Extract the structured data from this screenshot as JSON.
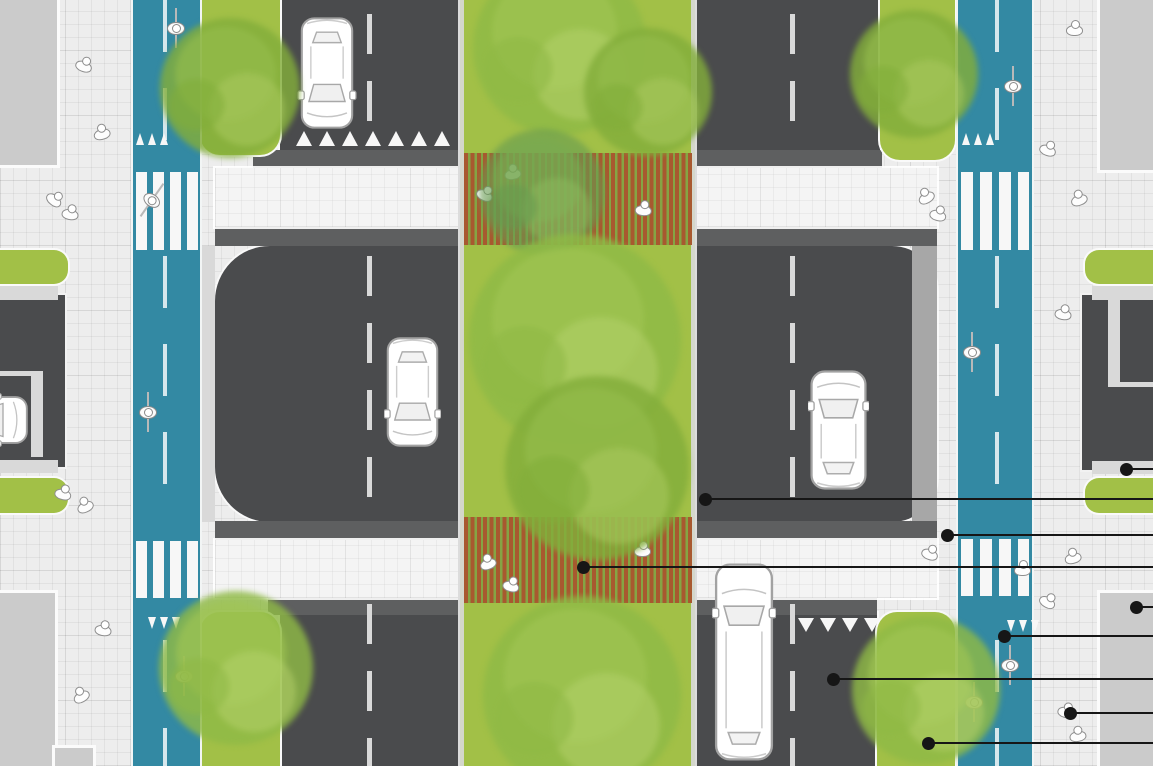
{
  "scene": {
    "width": 1153,
    "height": 766,
    "description": "top-down street plan with median walkway, raised crossings, protected bike lanes and callout markers"
  },
  "colors": {
    "sidewalk": "#ededed",
    "sidewalk_line": "rgba(0,0,0,0.05)",
    "crossing_table": "#f4f4f4",
    "crossing_table_line": "rgba(0,0,0,0.04)",
    "road": "#4a4b4d",
    "ramp": "#5e5f60",
    "bike_lane": "#3389a3",
    "grass": "#a2c047",
    "boardwalk_brown": "#a8592f",
    "boardwalk_gap": "#85a544",
    "building": "#cbcbcb",
    "curb_light": "#d9d9d9",
    "curb_gray": "#a7a7a7",
    "marking_white": "#f7f7f7",
    "road_dash": "#d9d9d9",
    "ink": "#161616"
  },
  "base": {
    "x": 0,
    "y": 0,
    "w": 1153,
    "h": 766
  },
  "buildings": [
    {
      "x": 0,
      "y": 0,
      "w": 57,
      "h": 165
    },
    {
      "x": 1100,
      "y": 0,
      "w": 53,
      "h": 170
    },
    {
      "x": 0,
      "y": 593,
      "w": 55,
      "h": 173
    },
    {
      "x": 1100,
      "y": 593,
      "w": 53,
      "h": 173
    },
    {
      "x": 55,
      "y": 748,
      "w": 38,
      "h": 18
    }
  ],
  "driveways": [
    {
      "part": "pavement",
      "x": 0,
      "y": 295,
      "w": 65,
      "h": 172
    },
    {
      "part": "curb",
      "x": 0,
      "y": 286,
      "w": 58,
      "h": 14
    },
    {
      "part": "curb",
      "x": 0,
      "y": 460,
      "w": 58,
      "h": 13
    },
    {
      "part": "divider",
      "x": 31,
      "y": 375,
      "w": 12,
      "h": 82
    },
    {
      "part": "divider",
      "x": 0,
      "y": 371,
      "w": 43,
      "h": 5
    },
    {
      "part": "pavement",
      "x": 1082,
      "y": 295,
      "w": 71,
      "h": 175
    },
    {
      "part": "curb",
      "x": 1092,
      "y": 286,
      "w": 61,
      "h": 14
    },
    {
      "part": "curb",
      "x": 1092,
      "y": 461,
      "w": 61,
      "h": 13
    },
    {
      "part": "divider",
      "x": 1108,
      "y": 300,
      "w": 12,
      "h": 84
    },
    {
      "part": "divider",
      "x": 1108,
      "y": 382,
      "w": 45,
      "h": 5
    }
  ],
  "roads": [
    {
      "x": 280,
      "y": 0,
      "w": 180,
      "h": 152
    },
    {
      "x": 695,
      "y": 0,
      "w": 185,
      "h": 152
    },
    {
      "x": 215,
      "y": 246,
      "w": 245,
      "h": 276,
      "r": "55px 0 0 55px"
    },
    {
      "x": 695,
      "y": 246,
      "w": 242,
      "h": 276,
      "r": "0 45px 45px 0"
    },
    {
      "x": 280,
      "y": 613,
      "w": 180,
      "h": 153
    },
    {
      "x": 695,
      "y": 613,
      "w": 182,
      "h": 153
    }
  ],
  "curbs": [
    {
      "x": 200,
      "y": 246,
      "w": 15,
      "h": 276,
      "fill": "curb_light"
    },
    {
      "x": 912,
      "y": 246,
      "w": 25,
      "h": 276,
      "fill": "curb_gray"
    }
  ],
  "ramps": [
    {
      "x": 253,
      "y": 150,
      "w": 207,
      "h": 18
    },
    {
      "x": 215,
      "y": 227,
      "w": 245,
      "h": 19
    },
    {
      "x": 695,
      "y": 150,
      "w": 187,
      "h": 18
    },
    {
      "x": 695,
      "y": 227,
      "w": 242,
      "h": 19
    },
    {
      "x": 215,
      "y": 521,
      "w": 245,
      "h": 19
    },
    {
      "x": 268,
      "y": 598,
      "w": 192,
      "h": 17
    },
    {
      "x": 695,
      "y": 521,
      "w": 242,
      "h": 19
    },
    {
      "x": 695,
      "y": 598,
      "w": 182,
      "h": 17
    }
  ],
  "crossing_tables": [
    {
      "x": 215,
      "y": 168,
      "w": 245,
      "h": 59
    },
    {
      "x": 695,
      "y": 168,
      "w": 242,
      "h": 59
    },
    {
      "x": 215,
      "y": 540,
      "w": 245,
      "h": 58
    },
    {
      "x": 695,
      "y": 540,
      "w": 242,
      "h": 58
    }
  ],
  "median": {
    "x": 460,
    "y": 0,
    "w": 235,
    "h": 766
  },
  "median_curbs": [
    {
      "x": 458,
      "y": 0,
      "w": 6,
      "h": 766
    },
    {
      "x": 691,
      "y": 0,
      "w": 6,
      "h": 766
    }
  ],
  "verges": [
    {
      "x": 200,
      "y": 0,
      "w": 80,
      "h": 155,
      "r": "0 0 20px 20px"
    },
    {
      "x": 880,
      "y": 0,
      "w": 75,
      "h": 160,
      "r": "0 0 20px 20px"
    },
    {
      "x": 0,
      "y": 250,
      "w": 68,
      "h": 34,
      "r": "0 14px 14px 0"
    },
    {
      "x": 0,
      "y": 478,
      "w": 68,
      "h": 35,
      "r": "0 14px 14px 0"
    },
    {
      "x": 1085,
      "y": 250,
      "w": 68,
      "h": 34,
      "r": "14px 0 0 14px"
    },
    {
      "x": 1085,
      "y": 478,
      "w": 68,
      "h": 35,
      "r": "14px 0 0 14px"
    },
    {
      "x": 200,
      "y": 612,
      "w": 80,
      "h": 154,
      "r": "20px 20px 0 0"
    },
    {
      "x": 877,
      "y": 612,
      "w": 78,
      "h": 154,
      "r": "20px 20px 0 0"
    }
  ],
  "boardwalks": [
    {
      "x": 464,
      "y": 153,
      "w": 228,
      "h": 92
    },
    {
      "x": 464,
      "y": 517,
      "w": 228,
      "h": 86
    }
  ],
  "bike_lanes": [
    {
      "x": 133,
      "y": 0,
      "w": 67,
      "h": 766
    },
    {
      "x": 958,
      "y": 0,
      "w": 74,
      "h": 766
    }
  ],
  "zebras": [
    {
      "x": 136,
      "y": 172,
      "w": 62,
      "h": 78,
      "bar": 11,
      "gap": 6
    },
    {
      "x": 961,
      "y": 172,
      "w": 68,
      "h": 78,
      "bar": 12,
      "gap": 7
    },
    {
      "x": 136,
      "y": 541,
      "w": 62,
      "h": 57,
      "bar": 11,
      "gap": 6
    },
    {
      "x": 961,
      "y": 539,
      "w": 68,
      "h": 57,
      "bar": 12,
      "gap": 7
    }
  ],
  "bike_dashes": [
    {
      "x": 163,
      "y": 0,
      "h": 146
    },
    {
      "x": 163,
      "y": 256,
      "h": 258
    },
    {
      "x": 163,
      "y": 640,
      "h": 126
    },
    {
      "x": 995,
      "y": 0,
      "h": 146
    },
    {
      "x": 995,
      "y": 256,
      "h": 258
    },
    {
      "x": 995,
      "y": 640,
      "h": 126
    }
  ],
  "road_dashes": [
    {
      "x": 367,
      "y": 14,
      "h": 132
    },
    {
      "x": 367,
      "y": 256,
      "h": 256
    },
    {
      "x": 367,
      "y": 604,
      "h": 162
    },
    {
      "x": 790,
      "y": 14,
      "h": 132
    },
    {
      "x": 790,
      "y": 256,
      "h": 256
    },
    {
      "x": 790,
      "y": 604,
      "h": 162
    }
  ],
  "teeth_rows": [
    {
      "x": 136,
      "y": 133,
      "count": 3,
      "tw": 9,
      "th": 12,
      "pitch": 12,
      "dir": "up"
    },
    {
      "x": 962,
      "y": 133,
      "count": 3,
      "tw": 9,
      "th": 12,
      "pitch": 12,
      "dir": "up"
    },
    {
      "x": 296,
      "y": 131,
      "count": 7,
      "tw": 16,
      "th": 15,
      "pitch": 23,
      "dir": "up"
    },
    {
      "x": 148,
      "y": 617,
      "count": 3,
      "tw": 9,
      "th": 12,
      "pitch": 12,
      "dir": "down"
    },
    {
      "x": 1007,
      "y": 620,
      "count": 3,
      "tw": 9,
      "th": 12,
      "pitch": 12,
      "dir": "down"
    },
    {
      "x": 798,
      "y": 618,
      "count": 4,
      "tw": 16,
      "th": 14,
      "pitch": 22,
      "dir": "down"
    }
  ],
  "tree_tones": {
    "base": [
      "#82ad3a",
      "#95bd4d",
      "#a9c95f"
    ],
    "mid": [
      "#8fb946",
      "#9fc553",
      "#b3cf69"
    ],
    "dark": [
      "#689b50",
      "#79aa52",
      "#8cb95d"
    ]
  },
  "trees": [
    {
      "cx": 560,
      "cy": 48,
      "r": 95,
      "tone": "mid"
    },
    {
      "cx": 648,
      "cy": 92,
      "r": 70,
      "tone": "base"
    },
    {
      "cx": 542,
      "cy": 192,
      "r": 68,
      "tone": "dark",
      "op": 0.6
    },
    {
      "cx": 575,
      "cy": 340,
      "r": 115,
      "tone": "mid"
    },
    {
      "cx": 597,
      "cy": 468,
      "r": 100,
      "tone": "base"
    },
    {
      "cx": 582,
      "cy": 695,
      "r": 108,
      "tone": "mid"
    },
    {
      "cx": 230,
      "cy": 88,
      "r": 76,
      "tone": "base"
    },
    {
      "cx": 236,
      "cy": 668,
      "r": 84,
      "tone": "mid"
    },
    {
      "cx": 914,
      "cy": 74,
      "r": 70,
      "tone": "base"
    },
    {
      "cx": 926,
      "cy": 690,
      "r": 80,
      "tone": "mid"
    }
  ],
  "vehicles": [
    {
      "type": "car",
      "x": 296,
      "y": 16,
      "w": 62,
      "h": 114,
      "facing": "down",
      "name": "parked-car"
    },
    {
      "type": "car",
      "x": 384,
      "y": 336,
      "w": 57,
      "h": 112,
      "facing": "down",
      "name": "car-southbound"
    },
    {
      "type": "car",
      "x": 808,
      "y": 369,
      "w": 61,
      "h": 122,
      "facing": "up",
      "name": "car-northbound"
    },
    {
      "type": "van",
      "x": 712,
      "y": 562,
      "w": 64,
      "h": 200,
      "facing": "up",
      "name": "van-northbound"
    },
    {
      "type": "car",
      "x": -52,
      "y": 368,
      "w": 58,
      "h": 104,
      "facing": "right",
      "name": "driveway-car"
    }
  ],
  "people": [
    [
      84,
      64,
      20
    ],
    [
      101,
      132,
      -15
    ],
    [
      55,
      198,
      40
    ],
    [
      70,
      212,
      10
    ],
    [
      925,
      196,
      -30
    ],
    [
      938,
      213,
      15
    ],
    [
      1074,
      28,
      0
    ],
    [
      1048,
      148,
      20
    ],
    [
      1078,
      198,
      -20
    ],
    [
      485,
      193,
      25
    ],
    [
      512,
      172,
      -10
    ],
    [
      643,
      208,
      5
    ],
    [
      63,
      492,
      15
    ],
    [
      84,
      505,
      -25
    ],
    [
      1063,
      312,
      10
    ],
    [
      930,
      552,
      20
    ],
    [
      1072,
      556,
      -15
    ],
    [
      1048,
      600,
      30
    ],
    [
      1022,
      568,
      0
    ],
    [
      487,
      562,
      -20
    ],
    [
      511,
      584,
      15
    ],
    [
      642,
      549,
      0
    ],
    [
      103,
      628,
      10
    ],
    [
      80,
      695,
      -30
    ],
    [
      1066,
      710,
      15
    ],
    [
      1077,
      734,
      -10
    ]
  ],
  "cyclists": [
    [
      176,
      28,
      0
    ],
    [
      152,
      200,
      35
    ],
    [
      148,
      412,
      0
    ],
    [
      184,
      676,
      0
    ],
    [
      1013,
      86,
      0
    ],
    [
      972,
      352,
      0
    ],
    [
      1010,
      665,
      0
    ],
    [
      974,
      702,
      0
    ]
  ],
  "callouts": [
    {
      "name": "driveway-apron",
      "x": 1126,
      "y": 469
    },
    {
      "name": "travel-lane",
      "x": 705,
      "y": 499
    },
    {
      "name": "crossing-island",
      "x": 947,
      "y": 535
    },
    {
      "name": "median-walkway",
      "x": 583,
      "y": 567
    },
    {
      "name": "building-frontage",
      "x": 1136,
      "y": 607
    },
    {
      "name": "bike-lane",
      "x": 1004,
      "y": 636
    },
    {
      "name": "parking-lane",
      "x": 833,
      "y": 679
    },
    {
      "name": "sidewalk",
      "x": 1070,
      "y": 713
    },
    {
      "name": "planting-strip",
      "x": 928,
      "y": 743
    }
  ]
}
